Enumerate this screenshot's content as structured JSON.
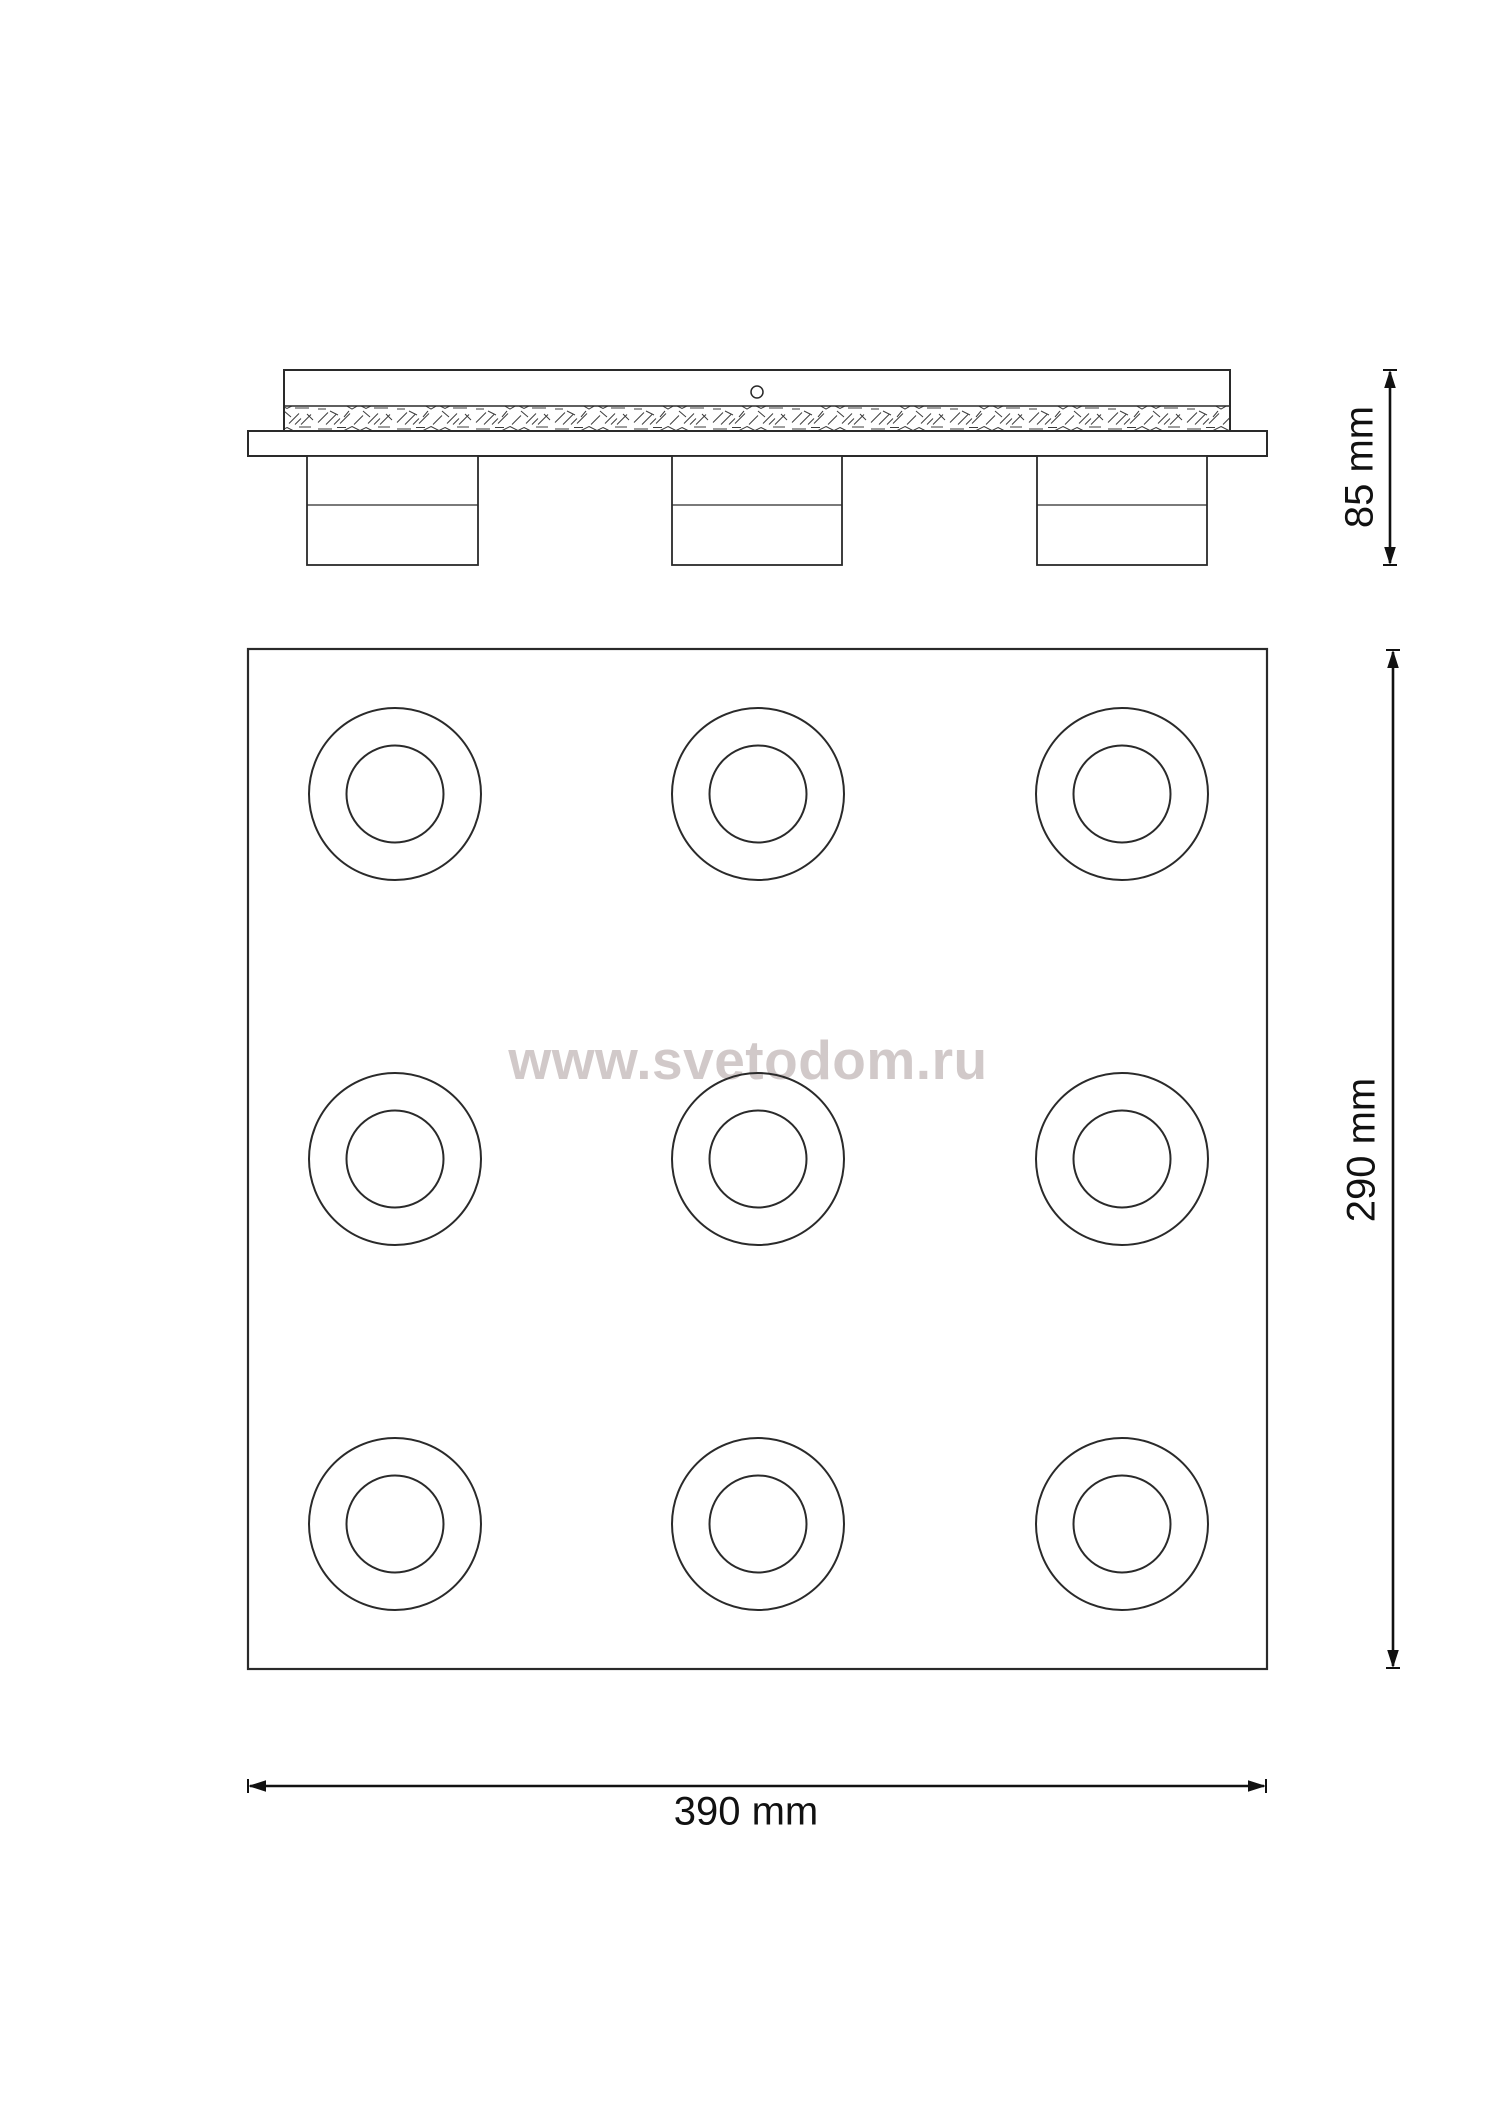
{
  "page": {
    "background_color": "#ffffff",
    "line_color": "#2a2a2a",
    "dimension_line_color": "#111111"
  },
  "watermark": {
    "text": "www.svetodom.ru",
    "color": "#d1c9c9"
  },
  "dimensions": {
    "height": {
      "label": "85 mm"
    },
    "depth": {
      "label": "290 mm"
    },
    "width": {
      "label": "390 mm"
    }
  }
}
